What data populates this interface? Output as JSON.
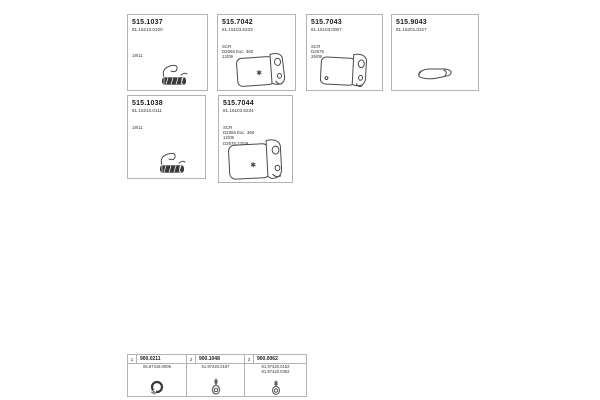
{
  "page": {
    "background": "#ffffff",
    "border_color": "#b3b3b3",
    "text_color": "#1a1a1a",
    "lineart_color": "#4a4a4a"
  },
  "boxes": [
    {
      "part_number": "515.1037",
      "oe_number": "81.15210.0100",
      "notes": [
        "19/11"
      ],
      "icon": "flex-pipe"
    },
    {
      "part_number": "515.7042",
      "oe_number": "81.15103.6233",
      "notes": [
        "SCR",
        "D2066 Exc. 360",
        "12/09"
      ],
      "icon": "muffler"
    },
    {
      "part_number": "515.7043",
      "oe_number": "81.15103.0067",
      "notes": [
        "SCR",
        "D2676",
        "26/08"
      ],
      "icon": "muffler"
    },
    {
      "part_number": "515.9043",
      "oe_number": "81.15201.0227",
      "notes": [],
      "icon": "bent-pipe"
    },
    {
      "part_number": "515.1038",
      "oe_number": "81.15210.0111",
      "notes": [
        "19/11"
      ],
      "icon": "flex-pipe"
    },
    {
      "part_number": "515.7044",
      "oe_number": "81.15103.6234",
      "notes": [
        "SCR",
        "D2066 Exc. 360",
        "12/09",
        "D2676 27/09"
      ],
      "icon": "muffler-large"
    }
  ],
  "accessories_table": {
    "rows": [
      {
        "index": "1",
        "part_number": "900.0211",
        "oe_numbers": [
          "06.67419.0006"
        ],
        "icon": "clamp"
      },
      {
        "index": "2",
        "part_number": "900.1048",
        "oe_numbers": [
          "51.97420.0187"
        ],
        "icon": "hanger-bolt"
      },
      {
        "index": "3",
        "part_number": "900.0062",
        "oe_numbers": [
          "81.97420.0152",
          "81.97420.0362"
        ],
        "icon": "hanger-bolt"
      }
    ]
  }
}
